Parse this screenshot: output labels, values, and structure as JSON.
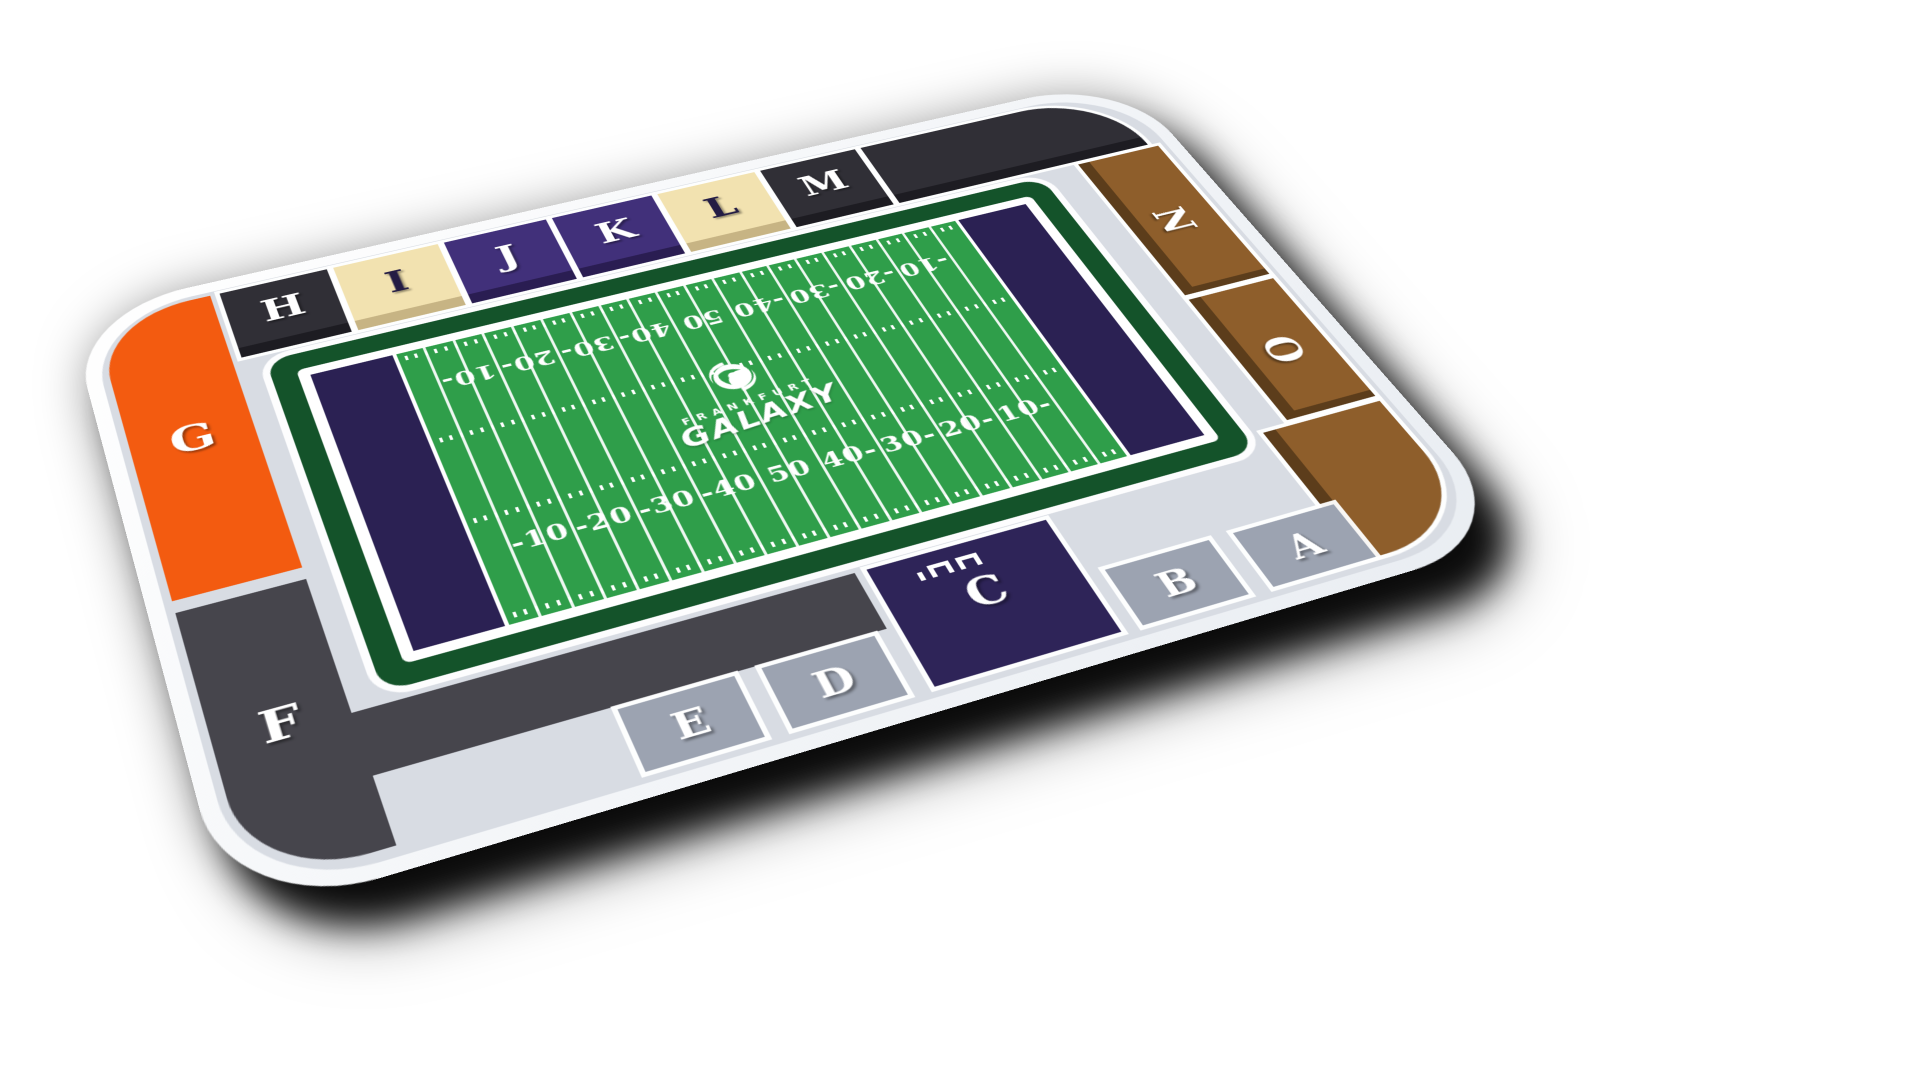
{
  "title": "Frankfurt Galaxy stadium seating map",
  "brand": {
    "club_small": "FRANKFURT",
    "club_big": "GALAXY"
  },
  "colors": {
    "background": "#ffffff",
    "rim": "#fbfcfe",
    "concourse": "#d8dce3",
    "field_green": "#2f9e4a",
    "field_dark_band": "#14532a",
    "endzone": "#2b2153",
    "line_white": "#ffffff",
    "drop_shadow": "#000000"
  },
  "sections": {
    "A": {
      "label": "A",
      "color": "#9ca3b1",
      "front": "#7e8694",
      "letter_color": "#ffffff"
    },
    "B": {
      "label": "B",
      "color": "#9ca3b1",
      "front": "#7e8694",
      "letter_color": "#ffffff"
    },
    "C": {
      "label": "C",
      "color": "#2e2458",
      "front": "#201946",
      "letter_color": "#ffffff"
    },
    "D": {
      "label": "D",
      "color": "#9ca3b1",
      "front": "#7e8694",
      "letter_color": "#ffffff"
    },
    "E": {
      "label": "E",
      "color": "#9ca3b1",
      "front": "#7e8694",
      "letter_color": "#ffffff"
    },
    "F": {
      "label": "F",
      "color": "#46454c",
      "front": "#2e2d33",
      "letter_color": "#ffffff"
    },
    "G": {
      "label": "G",
      "color": "#f35b10",
      "front": "#c4480c",
      "letter_color": "#ffffff"
    },
    "H": {
      "label": "H",
      "color": "#302f36",
      "front": "#1d1c22",
      "letter_color": "#ffffff"
    },
    "I": {
      "label": "I",
      "color": "#f2e2b0",
      "front": "#c7b484",
      "letter_color": "#241c44"
    },
    "J": {
      "label": "J",
      "color": "#41307a",
      "front": "#2a1d52",
      "letter_color": "#ffffff"
    },
    "K": {
      "label": "K",
      "color": "#41307a",
      "front": "#2a1d52",
      "letter_color": "#ffffff"
    },
    "L": {
      "label": "L",
      "color": "#f2e2b0",
      "front": "#c7b484",
      "letter_color": "#241c44"
    },
    "M": {
      "label": "M",
      "color": "#302f36",
      "front": "#1d1c22",
      "letter_color": "#ffffff"
    },
    "N": {
      "label": "N",
      "color": "#8e5e2b",
      "front": "#5c3d1b",
      "letter_color": "#ffffff"
    },
    "O": {
      "label": "O",
      "color": "#8e5e2b",
      "front": "#5c3d1b",
      "letter_color": "#ffffff"
    },
    "corner_top_right": {
      "label": "",
      "color": "#302f36",
      "front": "#1d1c22",
      "letter_color": "#ffffff"
    },
    "corner_bottom_right": {
      "label": "",
      "color": "#8e5e2b",
      "front": "#5c3d1b",
      "letter_color": "#ffffff"
    }
  },
  "field": {
    "yard_numbers_bottom": [
      "-10",
      "-20",
      "-30",
      "-40",
      "50",
      "40-",
      "30-",
      "20-",
      "10-"
    ],
    "yard_numbers_top": [
      "10-",
      "20-",
      "30-",
      "40-",
      "50",
      "-40",
      "-30",
      "-20",
      "-10"
    ],
    "yard_line_spacing_yards": 5,
    "yard_line_count": 21,
    "endzone_count": 2
  }
}
